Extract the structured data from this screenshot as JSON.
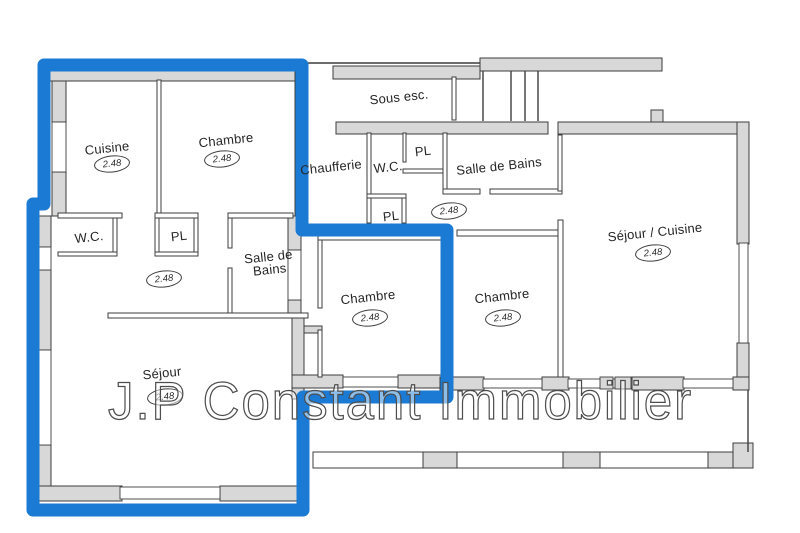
{
  "watermark": {
    "text": "J.P Constant Immobilier"
  },
  "colors": {
    "highlight_blue": "#1b7ad3",
    "wall_gray": "#d8d8d8",
    "wall_outline": "#3d3d3d"
  },
  "rooms": {
    "cuisine": {
      "label": "Cuisine",
      "height": "2.48"
    },
    "chambre_nw": {
      "label": "Chambre",
      "height": "2.48"
    },
    "sous_esc": {
      "label": "Sous esc."
    },
    "chaufferie": {
      "label": "Chaufferie"
    },
    "wc_mid": {
      "label": "W.C."
    },
    "pl_mid_upper": {
      "label": "PL"
    },
    "salle_de_bains_mid": {
      "label": "Salle de Bains",
      "height": "2.48"
    },
    "pl_mid_lower": {
      "label": "PL"
    },
    "sejour_cuisine": {
      "label": "Séjour / Cuisine",
      "height": "2.48"
    },
    "wc_left": {
      "label": "W.C."
    },
    "pl_left": {
      "label": "PL"
    },
    "hall_left": {
      "height": "2.48"
    },
    "salle_de_bains_left": {
      "line1": "Salle de",
      "line2": "Bains"
    },
    "chambre_mid": {
      "label": "Chambre",
      "height": "2.48"
    },
    "chambre_east": {
      "label": "Chambre",
      "height": "2.48"
    },
    "sejour": {
      "label": "Séjour",
      "height": "2.48"
    }
  }
}
